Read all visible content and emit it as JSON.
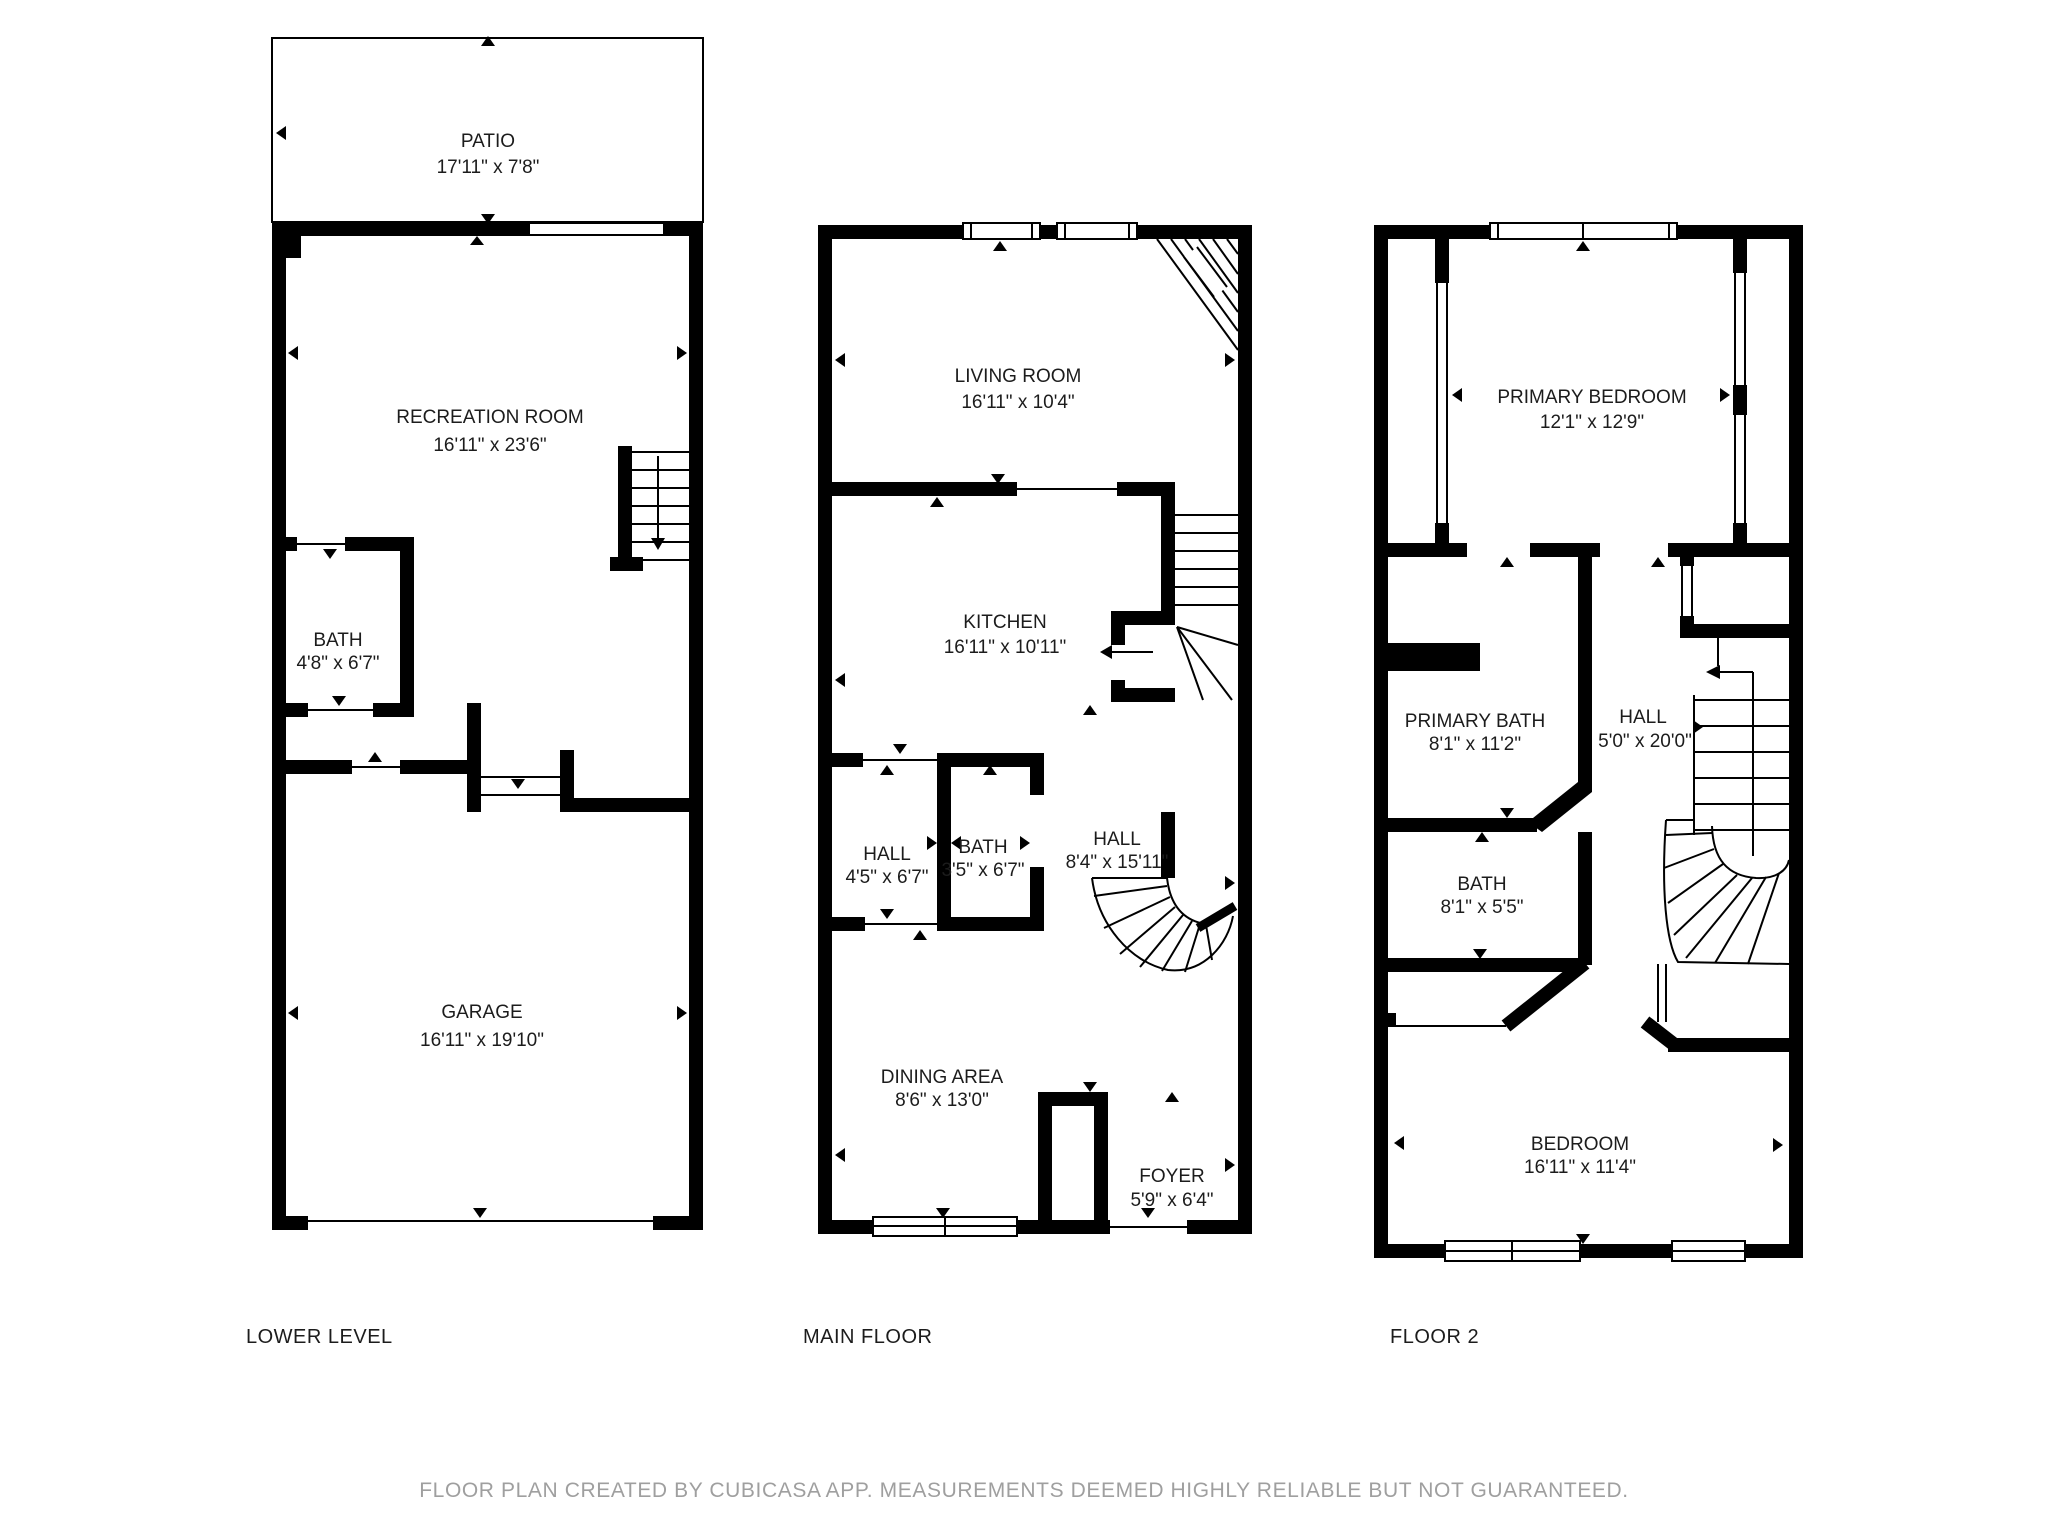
{
  "title": "Floor plan",
  "colors": {
    "wall": "#000000",
    "text": "#1c1c1c",
    "footer_text": "#9f9f9f",
    "background": "#ffffff"
  },
  "footer": "FLOOR PLAN CREATED BY CUBICASA APP. MEASUREMENTS DEEMED HIGHLY RELIABLE BUT NOT GUARANTEED.",
  "floors": [
    {
      "id": "lower-level",
      "title": "LOWER LEVEL",
      "rooms": [
        {
          "name": "PATIO",
          "dims": "17'11\" x 7'8\""
        },
        {
          "name": "RECREATION ROOM",
          "dims": "16'11\" x 23'6\""
        },
        {
          "name": "BATH",
          "dims": "4'8\" x 6'7\""
        },
        {
          "name": "GARAGE",
          "dims": "16'11\" x 19'10\""
        }
      ]
    },
    {
      "id": "main-floor",
      "title": "MAIN FLOOR",
      "rooms": [
        {
          "name": "LIVING ROOM",
          "dims": "16'11\" x 10'4\""
        },
        {
          "name": "KITCHEN",
          "dims": "16'11\" x 10'11\""
        },
        {
          "name": "HALL",
          "dims": "4'5\" x 6'7\""
        },
        {
          "name": "BATH",
          "dims": "3'5\" x 6'7\""
        },
        {
          "name": "HALL",
          "dims": "8'4\" x 15'11\""
        },
        {
          "name": "DINING AREA",
          "dims": "8'6\" x 13'0\""
        },
        {
          "name": "FOYER",
          "dims": "5'9\" x 6'4\""
        }
      ]
    },
    {
      "id": "floor-2",
      "title": "FLOOR 2",
      "rooms": [
        {
          "name": "PRIMARY BEDROOM",
          "dims": "12'1\" x 12'9\""
        },
        {
          "name": "PRIMARY BATH",
          "dims": "8'1\" x 11'2\""
        },
        {
          "name": "HALL",
          "dims": "5'0\" x 20'0\""
        },
        {
          "name": "BATH",
          "dims": "8'1\" x 5'5\""
        },
        {
          "name": "BEDROOM",
          "dims": "16'11\" x 11'4\""
        }
      ]
    }
  ]
}
